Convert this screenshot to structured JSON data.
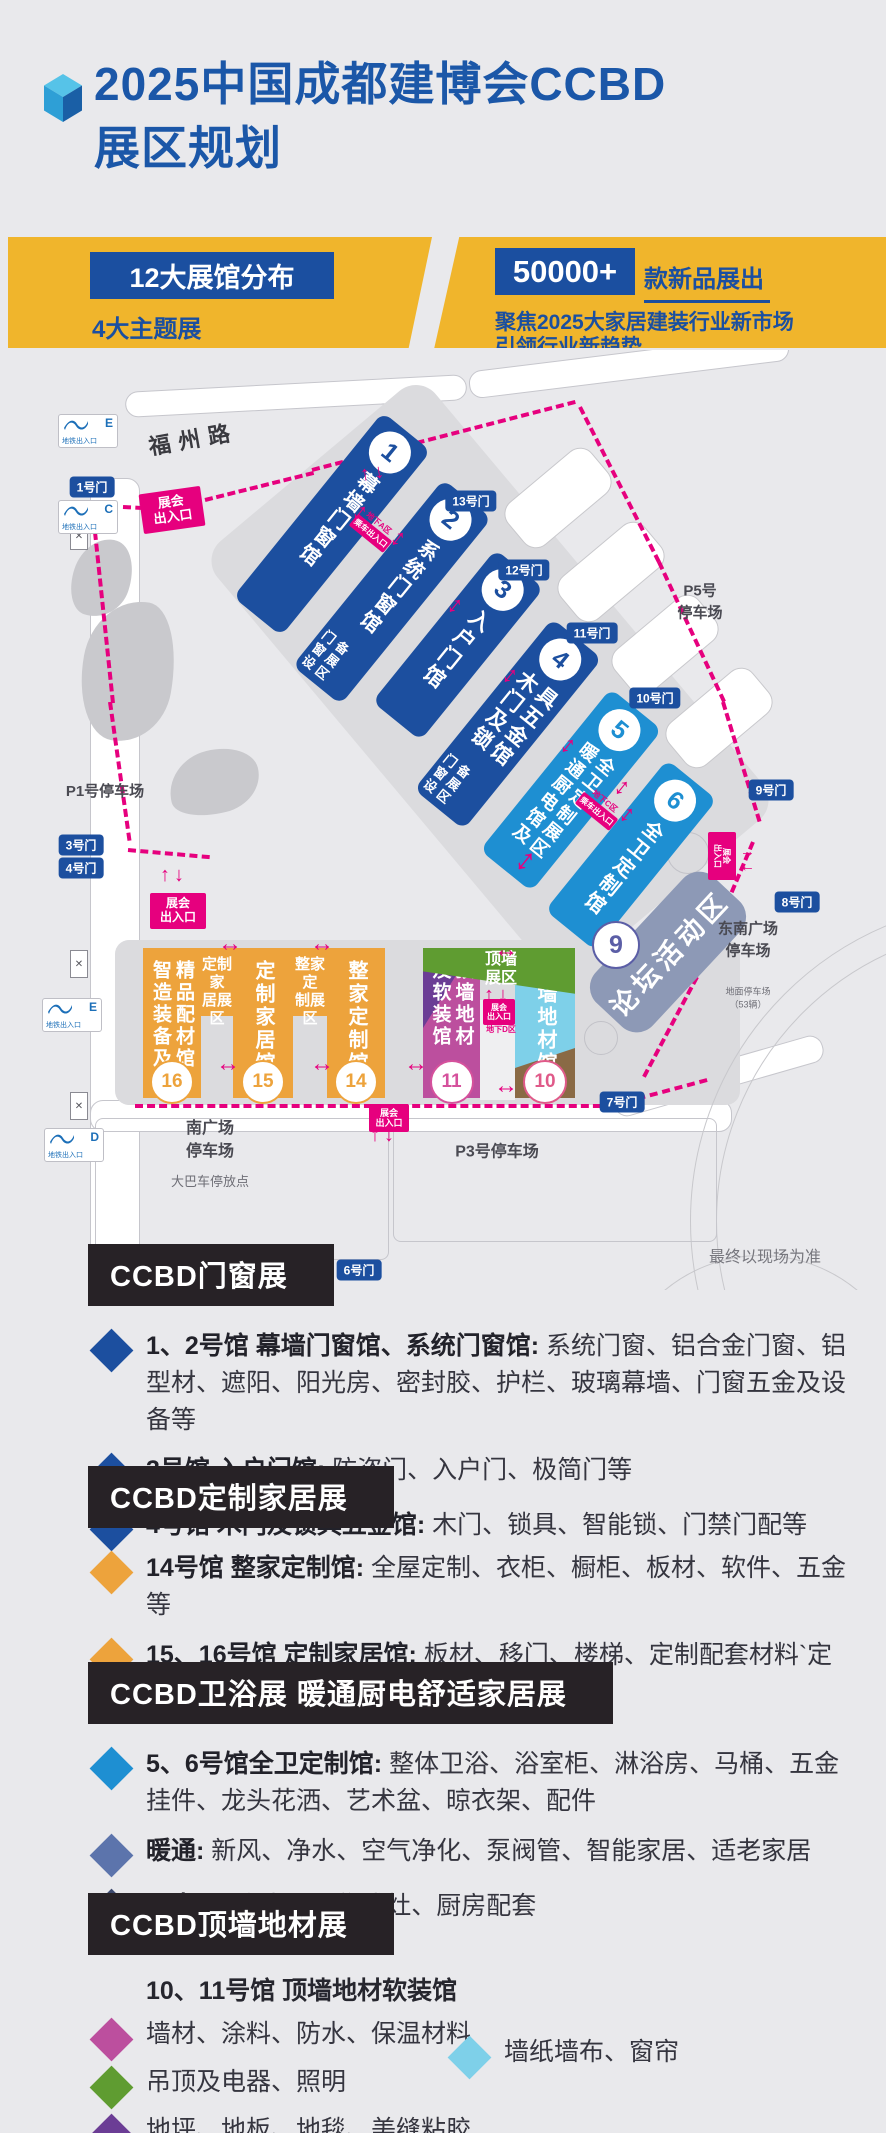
{
  "header": {
    "title_line1": "2025中国成都建博会CCBD",
    "title_line2": "展区规划",
    "title_color": "#1B57A8"
  },
  "banner": {
    "bg": "#F0B52C",
    "left": {
      "box_label": "12大展馆分布",
      "subtitle": "4大主题展"
    },
    "right": {
      "box_label": "50000+",
      "suffix": "款新品展出",
      "line1": "聚焦2025大家居建装行业新市场",
      "line2": "引领行业新趋势"
    }
  },
  "map": {
    "road_label": "福州路",
    "note": "最终以现场为准",
    "metro_label": "地铁出入口",
    "entrance_lines": [
      "展会",
      "出入口"
    ],
    "metro_entrances": [
      {
        "letter": "E",
        "x": 58,
        "y": 64
      },
      {
        "letter": "C",
        "x": 58,
        "y": 150
      },
      {
        "letter": "E",
        "x": 42,
        "y": 648
      },
      {
        "letter": "D",
        "x": 44,
        "y": 778
      }
    ],
    "gates": [
      {
        "label": "1号门",
        "cx": 92,
        "cy": 137
      },
      {
        "label": "13号门",
        "cx": 471,
        "cy": 151
      },
      {
        "label": "12号门",
        "cx": 524,
        "cy": 220
      },
      {
        "label": "11号门",
        "cx": 592,
        "cy": 283
      },
      {
        "label": "10号门",
        "cx": 655,
        "cy": 348
      },
      {
        "label": "9号门",
        "cx": 771,
        "cy": 440
      },
      {
        "label": "8号门",
        "cx": 797,
        "cy": 552
      },
      {
        "label": "7号门",
        "cx": 622,
        "cy": 752
      },
      {
        "label": "3号门",
        "cx": 81,
        "cy": 495
      },
      {
        "label": "4号门",
        "cx": 81,
        "cy": 518
      },
      {
        "label": "5号门",
        "cx": 200,
        "cy": 918
      },
      {
        "label": "6号门",
        "cx": 359,
        "cy": 920
      }
    ],
    "parkings": [
      {
        "lines": [
          "P1号停车场"
        ],
        "cx": 105,
        "cy": 442,
        "fs": 15
      },
      {
        "lines": [
          "P5号",
          "停车场"
        ],
        "cx": 700,
        "cy": 252,
        "fs": 15
      },
      {
        "lines": [
          "东南广场",
          "停车场"
        ],
        "cx": 748,
        "cy": 590,
        "fs": 15,
        "sub": [
          "地面停车场",
          "（53辆）"
        ],
        "sub_cy": 648,
        "sub_fs": 9
      },
      {
        "lines": [
          "南广场",
          "停车场"
        ],
        "cx": 210,
        "cy": 790,
        "fs": 16,
        "sub": [
          "大巴车停放点"
        ],
        "sub_cy": 832,
        "sub_fs": 13
      },
      {
        "lines": [
          "P3号停车场"
        ],
        "cx": 497,
        "cy": 802,
        "fs": 16
      }
    ],
    "entrances": [
      {
        "cx": 172,
        "cy": 160,
        "rot": -8,
        "w": 62,
        "h": 40,
        "fs": 13
      },
      {
        "cx": 178,
        "cy": 561,
        "rot": 0,
        "w": 56,
        "h": 36,
        "fs": 12
      },
      {
        "cx": 389,
        "cy": 768,
        "rot": 0,
        "w": 40,
        "h": 28,
        "fs": 9
      },
      {
        "cx": 499,
        "cy": 662,
        "rot": 0,
        "w": 32,
        "h": 26,
        "fs": 8
      },
      {
        "cx": 722,
        "cy": 506,
        "rot": 90,
        "w": 48,
        "h": 28,
        "fs": 8
      }
    ],
    "underground": [
      {
        "label": "地下A区",
        "sub": "乘车出入口",
        "cx": 372,
        "cy": 182,
        "rot": 39
      },
      {
        "label": "地下C区",
        "sub": "乘车出入口",
        "cx": 598,
        "cy": 460,
        "rot": 39
      },
      {
        "label": "地下D区",
        "cx": 499,
        "cy": 690,
        "rot": 0
      }
    ],
    "halls": [
      {
        "num": "1",
        "color": "#1C4F9F",
        "cols": [
          "幕墙门窗馆"
        ],
        "extra": null,
        "cx": 332,
        "cy": 174,
        "w": 62,
        "h": 238
      },
      {
        "num": "2",
        "color": "#1C4F9F",
        "cols": [
          "系统门窗馆"
        ],
        "extra": [
          "门窗设",
          "备展区"
        ],
        "cx": 392,
        "cy": 242,
        "w": 62,
        "h": 240
      },
      {
        "num": "3",
        "color": "#1C4F9F",
        "cols": [
          "入户门馆"
        ],
        "extra": null,
        "cx": 458,
        "cy": 295,
        "w": 62,
        "h": 196
      },
      {
        "num": "4",
        "color": "#1C4F9F",
        "cols": [
          "木门及锁",
          "具五金馆"
        ],
        "extra": [
          "门窗设",
          "备展区"
        ],
        "cx": 508,
        "cy": 374,
        "w": 64,
        "h": 220
      },
      {
        "num": "5",
        "color": "#1E8FD2",
        "cols": [
          "暖通厨电馆及",
          "全卫定制展区"
        ],
        "extra": null,
        "cx": 571,
        "cy": 440,
        "w": 66,
        "h": 208
      },
      {
        "num": "6",
        "color": "#1E8FD2",
        "cols": [
          "全卫定制馆"
        ],
        "extra": null,
        "cx": 631,
        "cy": 505,
        "w": 64,
        "h": 194
      }
    ],
    "bottom_halls": [
      {
        "num": "16",
        "cols": [
          "智造装备及",
          "精品配材馆"
        ],
        "x": 143,
        "w": 58,
        "color": "#EDA33C",
        "num_color": "#EDA33C"
      },
      {
        "num": "15",
        "cols": [
          "定制家居馆"
        ],
        "x": 233,
        "w": 60,
        "color": "#EDA33C",
        "num_color": "#EDA33C"
      },
      {
        "num": "14",
        "cols": [
          "整家定制馆"
        ],
        "x": 327,
        "w": 58,
        "color": "#EDA33C",
        "num_color": "#EDA33C"
      },
      {
        "num": "11",
        "cols": [
          "及软装馆",
          "顶墙地材"
        ],
        "x": 423,
        "w": 57,
        "color": "#BC4F9E",
        "num_color": "#D5519C",
        "triangle": "#6B3D95"
      },
      {
        "num": "10",
        "cols": [
          "顶墙地材馆"
        ],
        "x": 515,
        "w": 60,
        "color": "#7ED0E9",
        "num_color": "#E05A89",
        "brown": "#8A6A45"
      }
    ],
    "bridges": [
      {
        "lines": [
          "定制家",
          "居展区"
        ],
        "x": 201,
        "w": 32
      },
      {
        "lines": [
          "整家定",
          "制展区"
        ],
        "x": 293,
        "w": 34
      }
    ],
    "roof_band": {
      "lines": [
        "顶墙",
        "展区"
      ],
      "x": 423,
      "w": 152,
      "h": 52,
      "color": "#5F9C31"
    },
    "forum": {
      "num": "9",
      "label": "论坛活动区",
      "cx": 668,
      "cy": 602,
      "w": 172,
      "h": 78,
      "rot": -47,
      "color": "#8D99B6",
      "num_cx": 614,
      "num_cy": 593,
      "num_color": "#5B5EA6"
    }
  },
  "legend": {
    "sections": [
      {
        "top": 1244,
        "title": "CCBD门窗展",
        "items": [
          {
            "d": "#1C4F9F",
            "b": "1、2号馆 幕墙门窗馆、系统门窗馆:",
            "t": "系统门窗、铝合金门窗、铝型材、遮阳、阳光房、密封胶、护栏、玻璃幕墙、门窗五金及设备等"
          },
          {
            "d": "#1C4F9F",
            "b": "3号馆 入户门馆:",
            "t": "防盗门、入户门、极简门等"
          },
          {
            "d": "#1C4F9F",
            "b": "4号馆 木门及锁具五金馆:",
            "t": "木门、锁具、智能锁、门禁门配等"
          }
        ]
      },
      {
        "top": 1466,
        "title": "CCBD定制家居展",
        "items": [
          {
            "d": "#EDA33C",
            "b": "14号馆 整家定制馆:",
            "t": "全屋定制、衣柜、橱柜、板材、软件、五金等"
          },
          {
            "d": "#EDA33C",
            "b": "15、16号馆 定制家居馆:",
            "t": "板材、移门、楼梯、定制配套材料`定制产品设计软件等"
          }
        ]
      },
      {
        "top": 1662,
        "title": "CCBD卫浴展 暖通厨电舒适家居展",
        "items": [
          {
            "d": "#1E8FD2",
            "b": "5、6号馆全卫定制馆:",
            "t": "整体卫浴、浴室柜、淋浴房、马桶、五金挂件、龙头花洒、艺术盆、晾衣架、配件"
          },
          {
            "d": "#5C74AC",
            "b": "暖通:",
            "t": "新风、净水、空气净化、泵阀管、智能家居、适老家居"
          },
          {
            "d": "#3D4A6E",
            "b": "厨电:",
            "t": "厨房电器、集成灶、厨房配套"
          }
        ]
      },
      {
        "top": 1893,
        "title": "CCBD顶墙地材展",
        "subheader": "10、11号馆 顶墙地材软装馆",
        "items": [
          {
            "d": "#BC4F9E",
            "t": "墙材、涂料、防水、保温材料"
          },
          {
            "d": "#5F9C31",
            "t": "吊顶及电器、照明"
          },
          {
            "d": "#6B3D95",
            "t": "地坪、地板、地毯、美缝粘胶"
          },
          {
            "d": "#8A6A45",
            "t": "装饰线条、装配式快装、辅料及工具"
          }
        ],
        "side_item": {
          "d": "#7ED0E9",
          "t": "墙纸墙布、窗帘",
          "left": 446,
          "top": 142
        }
      }
    ]
  }
}
